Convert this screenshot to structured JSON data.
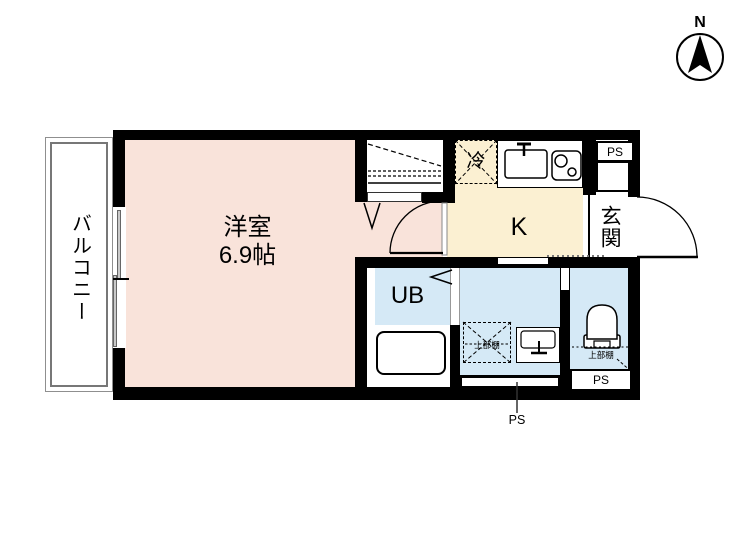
{
  "compass": {
    "label": "N"
  },
  "rooms": {
    "balcony": {
      "label": "バルコニー"
    },
    "western_room": {
      "label": "洋室",
      "size": "6.9帖"
    },
    "kitchen": {
      "label": "K"
    },
    "refrigerator": {
      "label": "冷"
    },
    "entrance": {
      "label": "玄関"
    },
    "unit_bath": {
      "label": "UB"
    },
    "washroom": {
      "shelf_label": "上部棚"
    },
    "toilet": {
      "shelf_label": "上部棚",
      "ps_label": "PS"
    }
  },
  "pipe_spaces": {
    "top_label": "PS",
    "bottom_label": "PS"
  },
  "colors": {
    "room_pink": "#f9e3da",
    "kitchen_cream": "#fbf0d2",
    "wet_blue": "#d5e9f6",
    "wall_black": "#000000",
    "balcony_gray": "#8f8f8f",
    "frame_gray": "#999999"
  }
}
